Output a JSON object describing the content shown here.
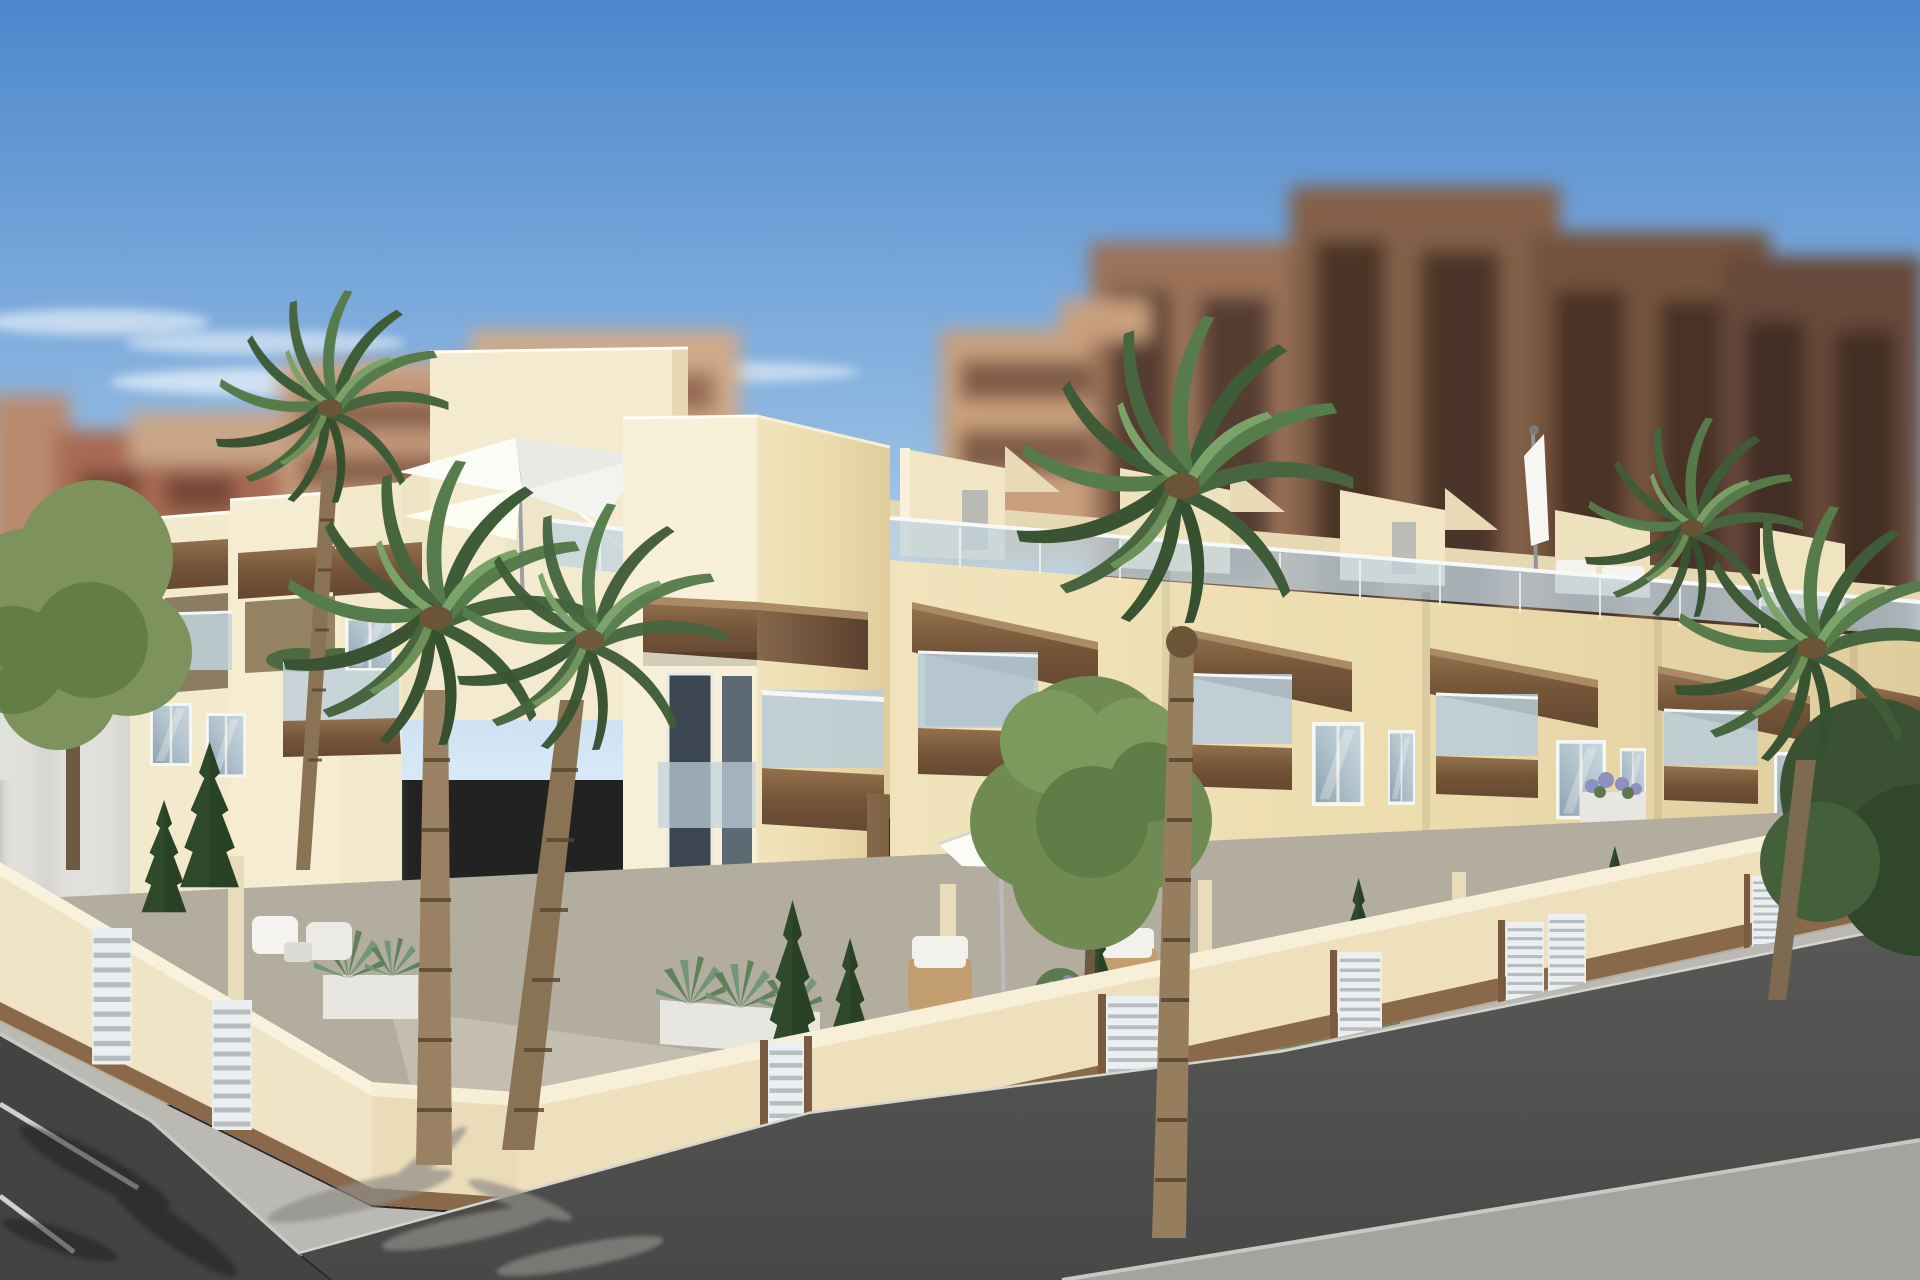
{
  "meta": {
    "title": "New-build townhouse development – exterior 3D render",
    "image_type": "architectural-render",
    "width_px": 1920,
    "height_px": 1280,
    "visible_text": []
  },
  "palette": {
    "sky_top": "#4c87cc",
    "sky_mid": "#8fb8e2",
    "sky_horizon": "#d9e9f6",
    "cloud": "#ffffff",
    "facade_bright": "#f6eed6",
    "facade_warm": "#efe1b7",
    "facade_deep": "#e0cc9c",
    "facade_shadow": "#c9b88e",
    "coping": "#faf3e0",
    "wood_dark": "#654832",
    "wood_light": "#93714f",
    "wood_cap": "#ab8a66",
    "glass_rail": "#c2d3dd",
    "window_frame": "#f6f6f3",
    "window_glass_hi": "#c8d6df",
    "window_glass_lo": "#8fa3b3",
    "dark_opening": "#332a20",
    "roller_shutter": "#d9d8d2",
    "fence_wall": "#eee2c0",
    "fence_base_wood": "#8a684a",
    "gate_white": "#eceff0",
    "sidewalk": "#bbb9b3",
    "curb": "#d6d4cf",
    "asphalt_main": "#4e4e4e",
    "asphalt_left": "#434343",
    "road_far_band": "#a4a39f",
    "parking_line": "#e9e9e6",
    "garden_paving": "#b3ada0",
    "grass": "#68794a",
    "conifer": "#2f4a2b",
    "tree_olive": "#6f8a52",
    "palm_dark": "#3f5c38",
    "palm_light": "#567c4b",
    "palm_trunk": "#8a7355",
    "palm_trunk_ring": "#57442f",
    "bg_brick": "#a96a52",
    "bg_tan": "#c49a7c",
    "bg_brown_1": "#9b7258",
    "bg_brown_2": "#84604a",
    "bg_brown_3": "#74523e",
    "bg_brown_4": "#68493a",
    "bg_white_building": "#e1e0dc",
    "umbrella": "#fbfbf8",
    "planter": "#e8e6e0",
    "flower_purple": "#8f8fc0",
    "wicker": "#c29e6e",
    "cushion": "#f2f1ec"
  },
  "scene": {
    "sky": {
      "label": "clear blue sky",
      "cloud_count": 6
    },
    "background_city": {
      "label": "blurred apartment blocks",
      "left_blocks": 4,
      "right_blocks": 5,
      "white_slab": 1
    },
    "building": {
      "label": "two-storey cream townhouse row with roof terraces",
      "bays_right_facade": 5,
      "features": [
        "wood lintel beams",
        "glass balustrade balconies with wood bases",
        "roof terraces with glass rails",
        "stair-box volumes",
        "roller shutter window",
        "timber door portals"
      ],
      "umbrella_count": 3
    },
    "garden": {
      "label": "front gardens behind cream perimeter wall",
      "gate_count": 7,
      "planters": 3,
      "conifers": 8,
      "wicker_chairs": 2,
      "garden_chairs": 2
    },
    "street": {
      "label": "corner street with sidewalk and parking lines",
      "parking_line_count": 2,
      "palm_shadows": true
    },
    "vegetation": {
      "palms": 6,
      "olive_trees": 2,
      "bushes": 2
    }
  }
}
